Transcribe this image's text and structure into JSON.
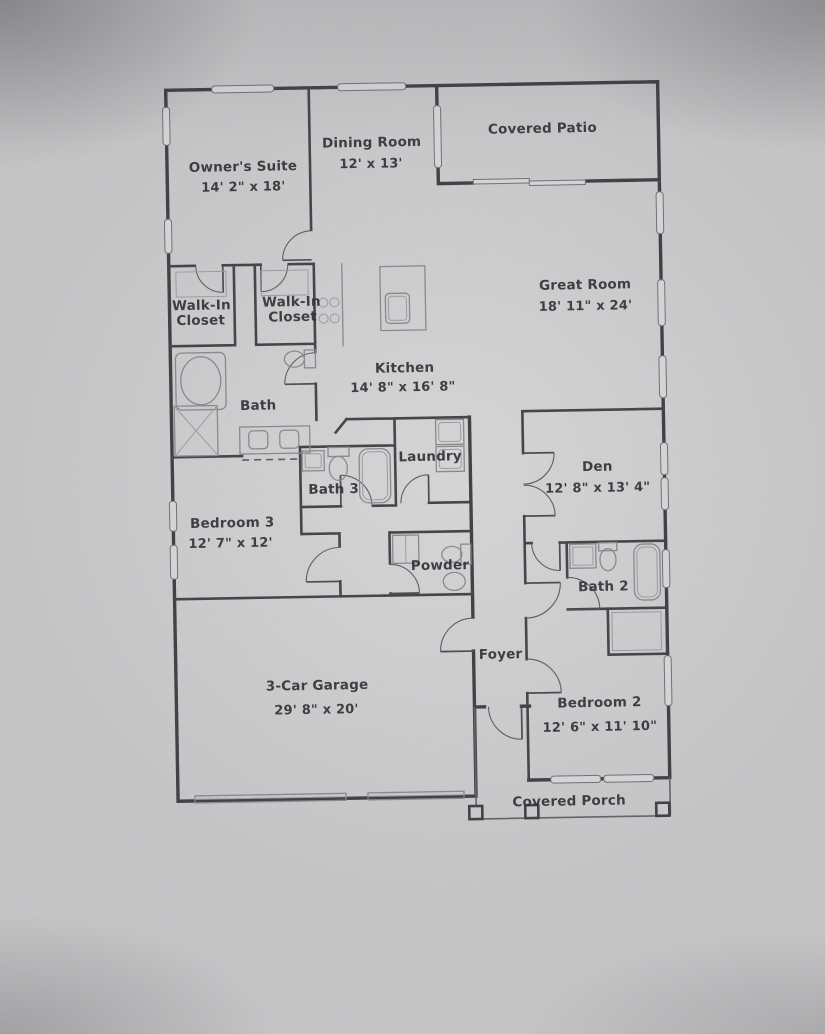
{
  "document": {
    "type": "single-story floor plan photo"
  },
  "colors": {
    "paper": "#c6c6c8",
    "wall_ink": "#3c3c40",
    "pencil": "#87878c",
    "label_ink": "#2c2c30"
  },
  "rooms": {
    "owners_suite": {
      "name": "Owner's Suite",
      "dims": "14' 2\" x 18'"
    },
    "dining_room": {
      "name": "Dining Room",
      "dims": "12' x 13'"
    },
    "covered_patio": {
      "name": "Covered Patio"
    },
    "great_room": {
      "name": "Great Room",
      "dims": "18' 11\" x 24'"
    },
    "walk_in_closet_1": {
      "line1": "Walk-In",
      "line2": "Closet"
    },
    "walk_in_closet_2": {
      "line1": "Walk-In",
      "line2": "Closet"
    },
    "kitchen": {
      "name": "Kitchen",
      "dims": "14' 8\" x 16' 8\""
    },
    "bath": {
      "name": "Bath"
    },
    "laundry": {
      "name": "Laundry"
    },
    "bath_3": {
      "name": "Bath 3"
    },
    "bedroom_3": {
      "name": "Bedroom 3",
      "dims": "12' 7\" x 12'"
    },
    "den": {
      "name": "Den",
      "dims": "12' 8\" x 13' 4\""
    },
    "powder": {
      "name": "Powder"
    },
    "bath_2": {
      "name": "Bath 2"
    },
    "foyer": {
      "name": "Foyer"
    },
    "garage": {
      "name": "3-Car Garage",
      "dims": "29' 8\" x 20'"
    },
    "bedroom_2": {
      "name": "Bedroom 2",
      "dims": "12' 6\" x 11' 10\""
    },
    "covered_porch": {
      "name": "Covered Porch"
    }
  }
}
